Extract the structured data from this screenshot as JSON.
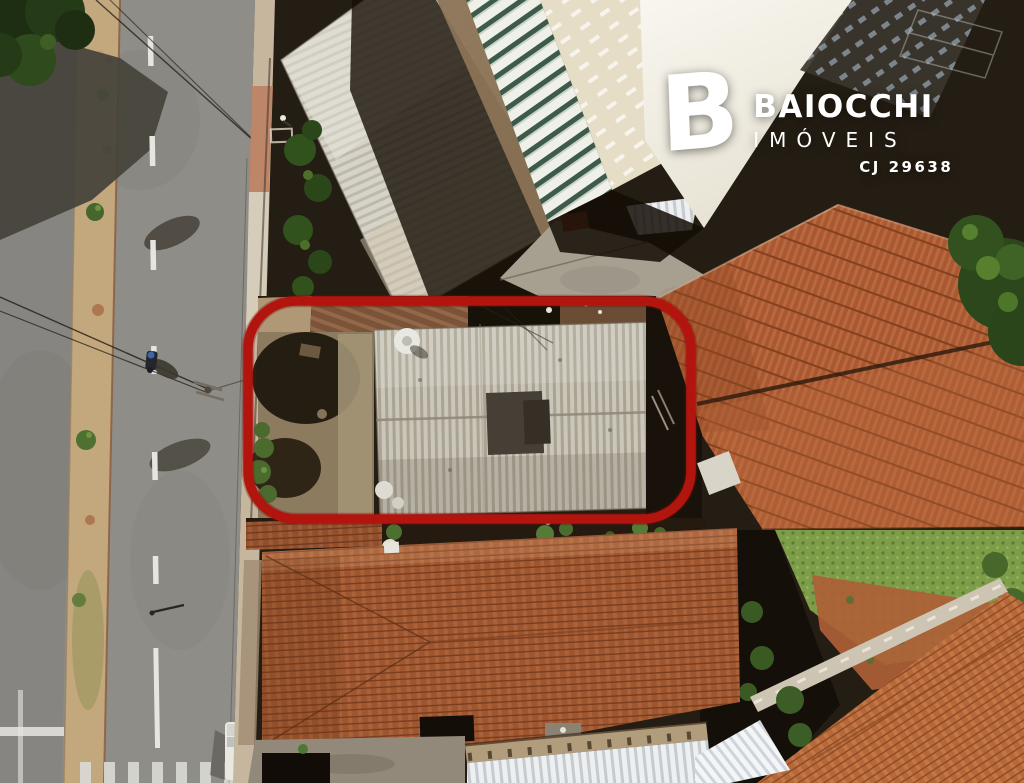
{
  "photo": {
    "type": "aerial-drone-photograph",
    "subject": "urban block with a property highlighted by a red rounded rectangle",
    "highlight_outline_color": "#b2150e"
  },
  "logo": {
    "mark": "B",
    "brand": "BAIOCCHI",
    "division": "IMÓVEIS",
    "license": "CJ 29638",
    "text_color": "#ffffff"
  }
}
